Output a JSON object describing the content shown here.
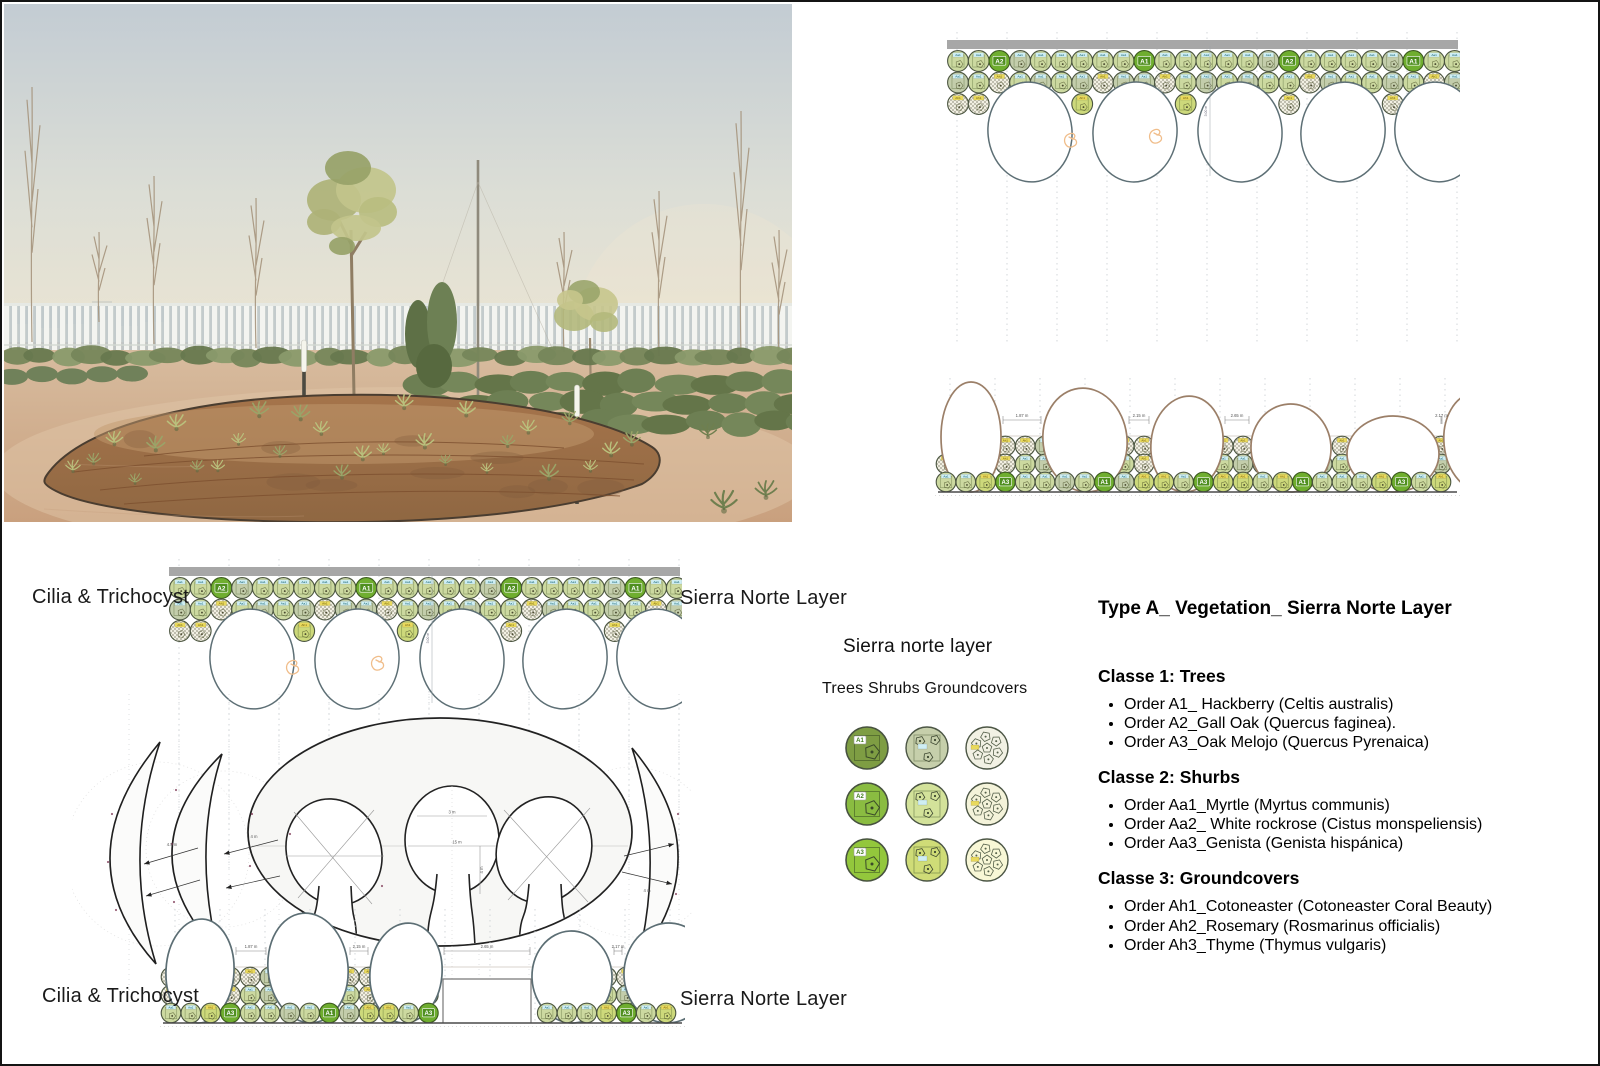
{
  "labels": {
    "cilia_top": "Cilia & Trichocyst",
    "sierra_top": "Sierra Norte Layer",
    "cilia_bottom": "Cilia & Trichocyst",
    "sierra_bottom": "Sierra Norte Layer"
  },
  "legend": {
    "title": "Sierra norte layer",
    "subtitle": "Trees Shrubs Groundcovers",
    "rows": [
      {
        "tree_label": "A1",
        "tree_color": "#7e9d43",
        "shrub_color": "#c6cfab",
        "ground_color": "#f2f1e4"
      },
      {
        "tree_label": "A2",
        "tree_color": "#8abc41",
        "shrub_color": "#d3e29a",
        "ground_color": "#f4f3da"
      },
      {
        "tree_label": "A3",
        "tree_color": "#93c73c",
        "shrub_color": "#cfdc77",
        "ground_color": "#f8f7d6"
      }
    ]
  },
  "classification": {
    "title": "Type A_ Vegetation_ Sierra Norte Layer",
    "sections": [
      {
        "heading": "Classe 1: Trees",
        "items": [
          "Order A1_  Hackberry (Celtis australis)",
          "Order A2_Gall Oak (Quercus faginea).",
          "Order A3_Oak Melojo (Quercus Pyrenaica)"
        ]
      },
      {
        "heading": "Classe 2: Shurbs",
        "items": [
          "Order Aa1_Myrtle (Myrtus communis)",
          "Order Aa2_ White rockrose (Cistus monspeliensis)",
          "Order Aa3_Genista (Genista hispánica)"
        ]
      },
      {
        "heading": "Classe 3: Groundcovers",
        "items": [
          "Order Ah1_Cotoneaster (Cotoneaster Coral Beauty)",
          "Order Ah2_Rosemary (Rosmarinus officialis)",
          "Order Ah3_Thyme (Thymus vulgaris)"
        ]
      }
    ]
  },
  "diagrams": {
    "plan": {
      "tree_chips": [
        "A2",
        "A1",
        "A2",
        "A1"
      ],
      "shrub_chip": "Aa1",
      "ground_chip": "Ah1",
      "inner_dim": "3.00 m"
    },
    "section": {
      "widths": [
        "1.87 m",
        "2.15 m",
        "2.65 m",
        "2.17 m"
      ],
      "height": "3.04 m",
      "bottom_chips": [
        "A3",
        "A1",
        "A3",
        "A1",
        "A3"
      ]
    },
    "shape": {
      "dim_left_outer": "4.5 m",
      "dim_left_inner": "4 m",
      "dim_lobe_top": "3 m",
      "dim_lobe_mid": "15 m",
      "dim_lobe_v": "4 m",
      "dim_right": "4 m"
    },
    "palette": {
      "bar": "#a7a7a7",
      "ellipse_stroke": "#5d6f75",
      "section_tree_stroke": "#9b7f68",
      "section_tree_stroke_alt": "#5c6e74",
      "shrub_light": "#ccd9a0",
      "shrub_sage": "#c3cdab",
      "shrub_yellow": "#cdd97b",
      "tree_fill": "#6fae2f",
      "chip_green": "#4f8f1f",
      "chip_cyan": "#cfeef3",
      "chip_yellow": "#e9d95d",
      "hatch_base": "#f2f0e3",
      "orange": "#f0bd8a",
      "ground_line": "#4a4a4a"
    }
  },
  "photo_palette": {
    "sky_top": "#c3ccd3",
    "sky_mid": "#dcded6",
    "sky_bottom": "#ece5d2",
    "sand_top": "#d8bda0",
    "sand_bottom": "#c9a07e",
    "soil": "#a5744b",
    "soil_dark": "#8f6742",
    "fence": "#f3f4f0",
    "fence_gap": "#bcc7cc",
    "shrub_green": "#6d7f53",
    "tree_foliage": "#b3b87b",
    "trunk": "#8f7d63"
  }
}
